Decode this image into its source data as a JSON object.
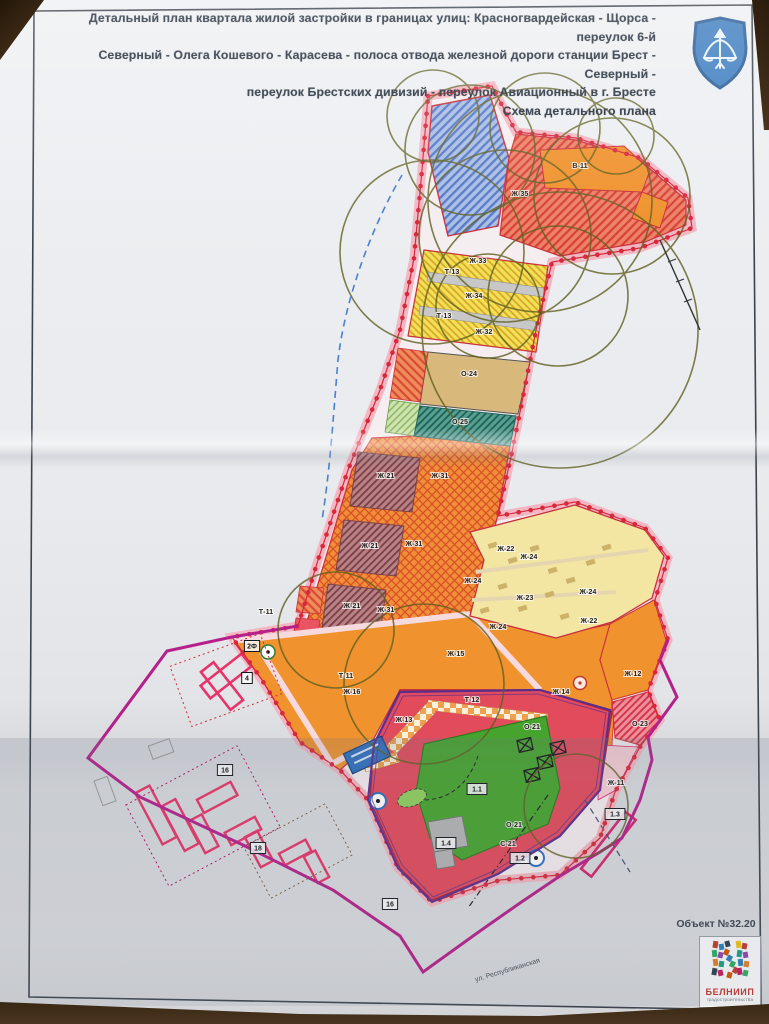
{
  "sheet": {
    "title_lines": [
      "Детальный план квартала жилой застройки в границах улиц: Красногвардейская - Щорса - переулок 6-й",
      "Северный - Олега Кошевого - Карасева - полоса отвода железной дороги станции Брест - Северный -",
      "переулок Брестских дивизий - переулок Авиационный в г. Бресте",
      "Схема детального плана"
    ],
    "object_number": "Объект №32.20",
    "logo": {
      "name": "БЕЛНИИП",
      "subtitle": "градостроительства"
    },
    "emblem_alt": "герб г. Бреста — лук со стрелой на голубом щите"
  },
  "map": {
    "zone_labels": [
      {
        "text": "В-11",
        "x": 580,
        "y": 168
      },
      {
        "text": "Ж-35",
        "x": 520,
        "y": 196
      },
      {
        "text": "Ж-33",
        "x": 478,
        "y": 263
      },
      {
        "text": "Ж-34",
        "x": 474,
        "y": 298
      },
      {
        "text": "Ж-32",
        "x": 484,
        "y": 334
      },
      {
        "text": "О-24",
        "x": 469,
        "y": 376
      },
      {
        "text": "О-25",
        "x": 460,
        "y": 424
      },
      {
        "text": "Ж-31",
        "x": 440,
        "y": 478
      },
      {
        "text": "Ж-31",
        "x": 414,
        "y": 546
      },
      {
        "text": "Ж-31",
        "x": 386,
        "y": 612
      },
      {
        "text": "Ж-21",
        "x": 386,
        "y": 478
      },
      {
        "text": "Ж-21",
        "x": 370,
        "y": 548
      },
      {
        "text": "Ж-21",
        "x": 352,
        "y": 608
      },
      {
        "text": "Ж-22",
        "x": 506,
        "y": 551
      },
      {
        "text": "Ж-24",
        "x": 529,
        "y": 559
      },
      {
        "text": "Ж-24",
        "x": 473,
        "y": 583
      },
      {
        "text": "Ж-23",
        "x": 525,
        "y": 600
      },
      {
        "text": "Ж-24",
        "x": 498,
        "y": 629
      },
      {
        "text": "Ж-24",
        "x": 588,
        "y": 594
      },
      {
        "text": "Ж-22",
        "x": 589,
        "y": 623
      },
      {
        "text": "Ж-12",
        "x": 633,
        "y": 676
      },
      {
        "text": "Ж-14",
        "x": 561,
        "y": 694
      },
      {
        "text": "Ж-15",
        "x": 456,
        "y": 656
      },
      {
        "text": "Ж-16",
        "x": 352,
        "y": 694
      },
      {
        "text": "Ж-13",
        "x": 404,
        "y": 722
      },
      {
        "text": "О-21",
        "x": 532,
        "y": 729
      },
      {
        "text": "О-21",
        "x": 514,
        "y": 827
      },
      {
        "text": "О-23",
        "x": 640,
        "y": 726
      },
      {
        "text": "Ж-11",
        "x": 616,
        "y": 785
      },
      {
        "text": "С-21",
        "x": 508,
        "y": 846
      },
      {
        "text": "Т-13",
        "x": 452,
        "y": 274
      },
      {
        "text": "Т-13",
        "x": 444,
        "y": 318
      },
      {
        "text": "Т-11",
        "x": 266,
        "y": 614
      },
      {
        "text": "Т-11",
        "x": 346,
        "y": 678
      },
      {
        "text": "Т-12",
        "x": 472,
        "y": 702
      }
    ],
    "index_labels": [
      {
        "text": "4",
        "x": 247,
        "y": 678
      },
      {
        "text": "2Ф",
        "x": 252,
        "y": 646
      },
      {
        "text": "16",
        "x": 225,
        "y": 770
      },
      {
        "text": "18",
        "x": 258,
        "y": 848
      },
      {
        "text": "16",
        "x": 390,
        "y": 904
      },
      {
        "text": "1.1",
        "x": 477,
        "y": 789
      },
      {
        "text": "1.2",
        "x": 520,
        "y": 858
      },
      {
        "text": "1.3",
        "x": 615,
        "y": 814
      },
      {
        "text": "1.4",
        "x": 446,
        "y": 843
      }
    ],
    "street_labels": [
      {
        "text": "ул. Республиканская",
        "x": 508,
        "y": 972,
        "angle": -17
      }
    ],
    "colors": {
      "residential_orange": "#f0922e",
      "residential_lowrise_yellow": "#f3e6a3",
      "public_red": "#e24b5c",
      "sports_green": "#46a42e",
      "boundary_magenta": "#b5208a",
      "boundary_purple": "#5b2d8e",
      "buffer_pink": "#f3b5c0",
      "radius_circle_olive": "#5f5f1f"
    }
  }
}
